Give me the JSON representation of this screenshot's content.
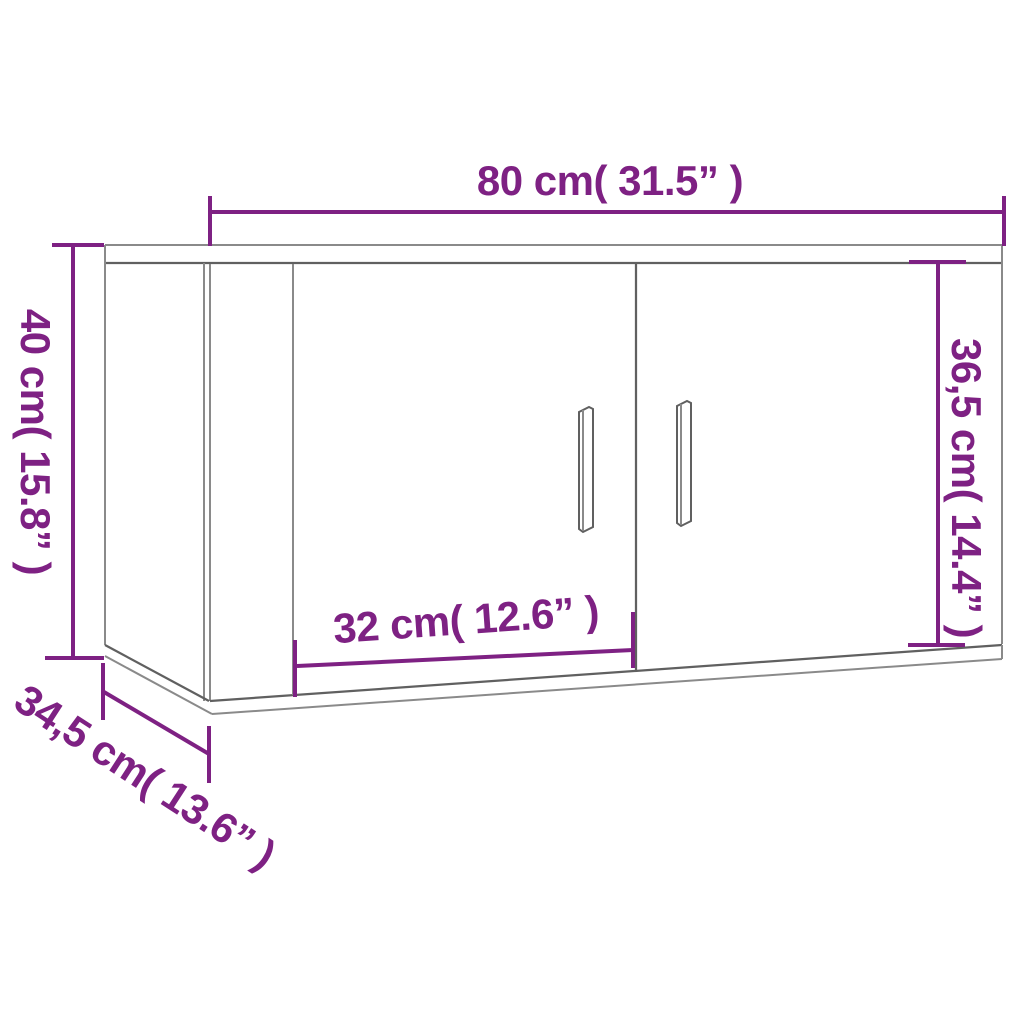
{
  "diagram": {
    "type": "product-dimension-diagram",
    "product": "wall-mounted-cabinet-two-doors",
    "colors": {
      "accent": "#7E2183",
      "line": "#8A8A8A",
      "line_dark": "#606060",
      "background": "#FFFFFF"
    },
    "dimensions": {
      "width": "80 cm( 31.5” )",
      "height": "40 cm( 15.8” )",
      "interior_height": "36,5 cm( 14.4” )",
      "door_width": "32 cm( 12.6” )",
      "depth": "34,5 cm( 13.6” )"
    }
  }
}
